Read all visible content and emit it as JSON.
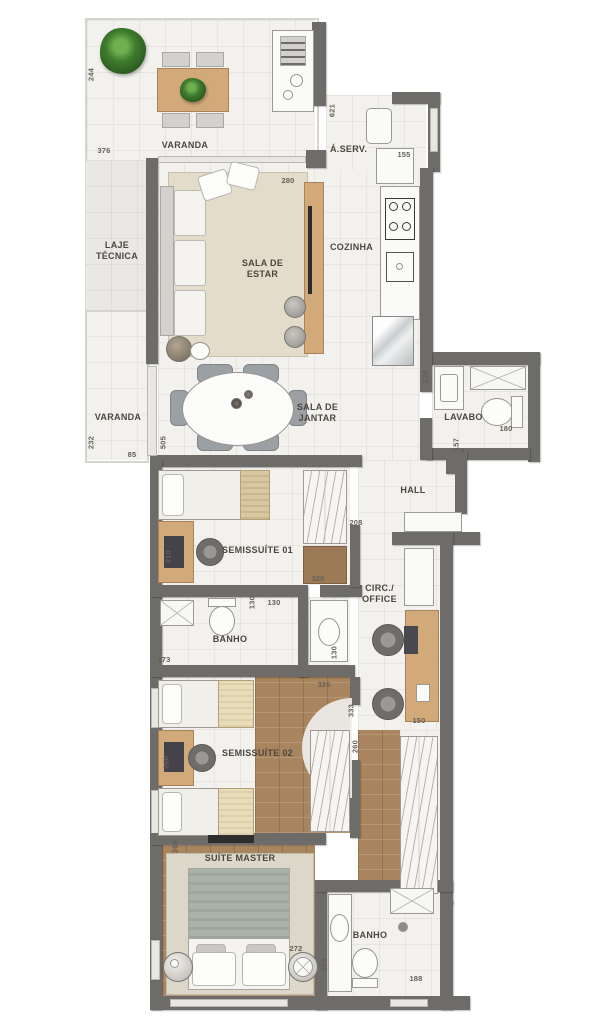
{
  "plan_title": "Apartment floor plan",
  "colors": {
    "wall": "#6e6c68",
    "floor_tile": "#f2f1ee",
    "wood_floor": "#a9855f",
    "rug": "#e3dcca",
    "wood_furniture": "#d2aa7a",
    "plant_green": "#3f7c2e"
  },
  "rooms": {
    "varanda_top": {
      "label": "VARANDA"
    },
    "aserv": {
      "label": "Á.SERV."
    },
    "laje": {
      "label": "LAJE\nTÉCNICA"
    },
    "sala_estar": {
      "label": "SALA DE\nESTAR"
    },
    "cozinha": {
      "label": "COZINHA"
    },
    "varanda_left": {
      "label": "VARANDA"
    },
    "sala_jantar": {
      "label": "SALA DE\nJANTAR"
    },
    "lavabo": {
      "label": "LAVABO"
    },
    "hall": {
      "label": "HALL"
    },
    "semissuite1": {
      "label": "SEMISSUÍTE 01"
    },
    "banho1": {
      "label": "BANHO"
    },
    "circ": {
      "label": "CIRC./\nOFFICE"
    },
    "semissuite2": {
      "label": "SEMISSUÍTE 02"
    },
    "suite_master": {
      "label": "SUÍTE MASTER"
    },
    "banho2": {
      "label": "BANHO"
    }
  },
  "dims": {
    "varanda_h": "244",
    "varanda_w": "376",
    "coz_h": "621",
    "aserv_w": "155",
    "sala_w": "280",
    "varanda2_h": "232",
    "varanda2_w": "85",
    "jantar_h": "505",
    "lavabo_sink": "120",
    "lavabo_w": "180",
    "hall_h": "157",
    "hall_w": "208",
    "semi1_desk": "210",
    "semi1_w": "320",
    "banho1_h": "130",
    "banho1_w": "130",
    "banho1_floor": "173",
    "banho1_sink": "130",
    "circ_h": "333",
    "circ_w": "150",
    "semi2_w": "320",
    "semi2_desk": "260",
    "semi2_h": "260",
    "master_h": "269",
    "master_w": "272",
    "banho2_h": "165",
    "banho2_w": "188"
  }
}
